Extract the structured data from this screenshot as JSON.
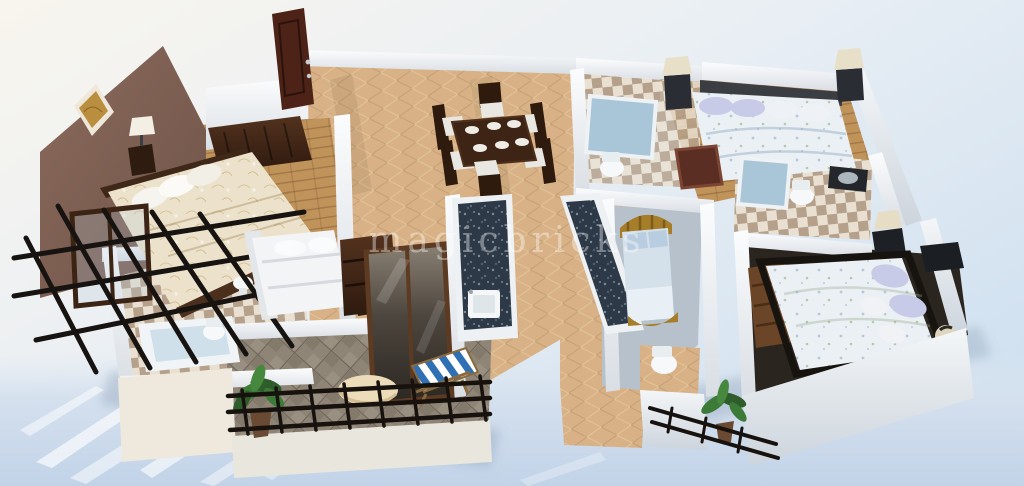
{
  "watermark": {
    "text": "magicbricks"
  },
  "scene": {
    "description": "Photorealistic 3D isometric floor-plan render of a multi-room apartment on a pale blue reflective studio background",
    "rooms": [
      {
        "name": "bedroom-top-left",
        "features": [
          "brown accent wall with diamond wall art",
          "double bed with cream floral bedding",
          "dark wood dresser",
          "nightstand with lamp",
          "wood plank floor",
          "glass partition"
        ]
      },
      {
        "name": "bathroom-left",
        "features": [
          "white bathtub",
          "pedestal washbasin",
          "toilet",
          "checkered marble tiles",
          "black garden trellis outside"
        ]
      },
      {
        "name": "living-room",
        "features": [
          "white leather sofa",
          "dark wood display unit",
          "beige marble flooring"
        ]
      },
      {
        "name": "dining-area",
        "features": [
          "dark wood dining table",
          "six chairs with white cushions",
          "place settings"
        ]
      },
      {
        "name": "entrance",
        "features": [
          "dark mahogany open door"
        ]
      },
      {
        "name": "kitchen",
        "features": [
          "two parallel counters",
          "black granite worktops",
          "white sink"
        ]
      },
      {
        "name": "bedroom-center",
        "features": [
          "bed with golden arched headboard and footboard",
          "light blue bedding"
        ]
      },
      {
        "name": "bathroom-top-center",
        "features": [
          "light blue bathtub",
          "toilet",
          "checkered tile wall"
        ]
      },
      {
        "name": "bedroom-top-right",
        "features": [
          "double bed with blue floral bedding",
          "lavender pillows",
          "two nightstands with cream lamps",
          "dark red rug"
        ]
      },
      {
        "name": "bathroom-right",
        "features": [
          "light blue bathtub",
          "toilet",
          "dark vanity with steel basin",
          "checkered tiles"
        ]
      },
      {
        "name": "master-bedroom-bottom-right",
        "features": [
          "king bed with white floral duvet",
          "lavender pillows",
          "globe table lamp",
          "wooden dresser"
        ]
      },
      {
        "name": "balcony",
        "features": [
          "stone diamond tiles",
          "potted plant",
          "round cream table",
          "blue and white striped lounger",
          "black metal railing",
          "dark glass sliding door"
        ]
      },
      {
        "name": "wc-bottom-center",
        "features": [
          "toilet",
          "palm plant",
          "black railing"
        ]
      }
    ],
    "palette": {
      "background_top_left": "#f8f5ee",
      "background_right": "#d3e3f2",
      "ground_reflection": "#c2d3e8",
      "wall_light": "#fbfcfd",
      "wall_shade": "#d9dee4",
      "floor_marble": "#d8b286",
      "floor_wood": "#c0935b",
      "accent_wall_brown": "#7f6156",
      "furniture_dark_wood": "#46291b",
      "granite_counter": "#2e3947",
      "bathtub_blue": "#a9c6d8",
      "bedding_cream": "#ece2cc",
      "bedding_blue": "#ebf0f4",
      "pillow_lavender": "#c7cbe7",
      "lounger_stripe_blue": "#2f6fb4",
      "railing_black": "#17120e",
      "plant_green": "#3c7a38",
      "stone_tile": "#8f8577"
    }
  }
}
